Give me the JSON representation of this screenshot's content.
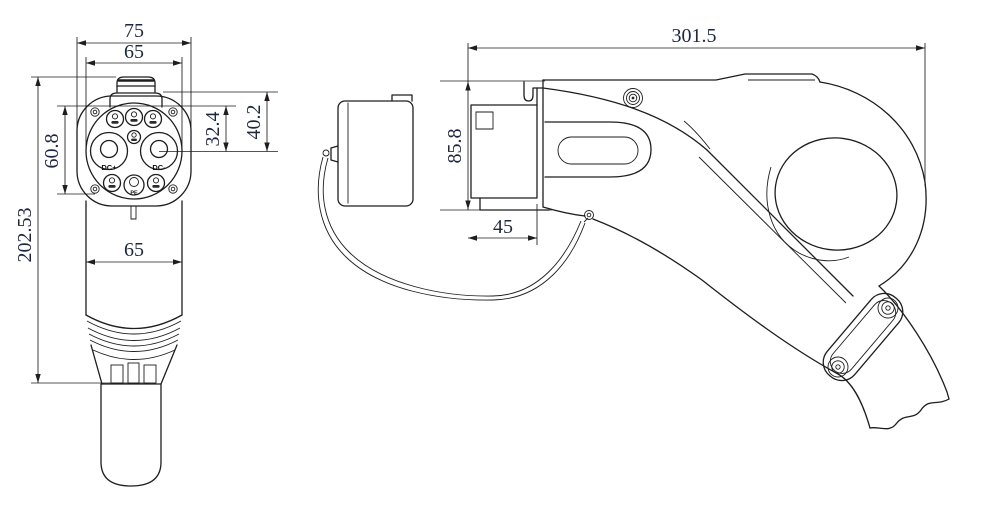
{
  "drawing": {
    "type": "engineering-2-view",
    "subject": "EV DC fast-charging connector gun",
    "colors": {
      "line": "#1e1e1e",
      "dim_text": "#1d2742",
      "background": "#ffffff"
    },
    "front_view": {
      "dim_overall_width": "75",
      "dim_face_diameter": "65",
      "dim_pin_span_vertical": "60.8",
      "dim_overall_height": "202.53",
      "dim_pin_row_to_center": "32.4",
      "dim_top_to_center": "40.2",
      "dim_body_width": "65",
      "pin_labels": {
        "dc_plus": "DC+",
        "dc_minus": "DC-",
        "pe": "PE"
      }
    },
    "side_view": {
      "dim_overall_length": "301.5",
      "dim_front_height": "85.8",
      "dim_nozzle_length": "45"
    }
  }
}
